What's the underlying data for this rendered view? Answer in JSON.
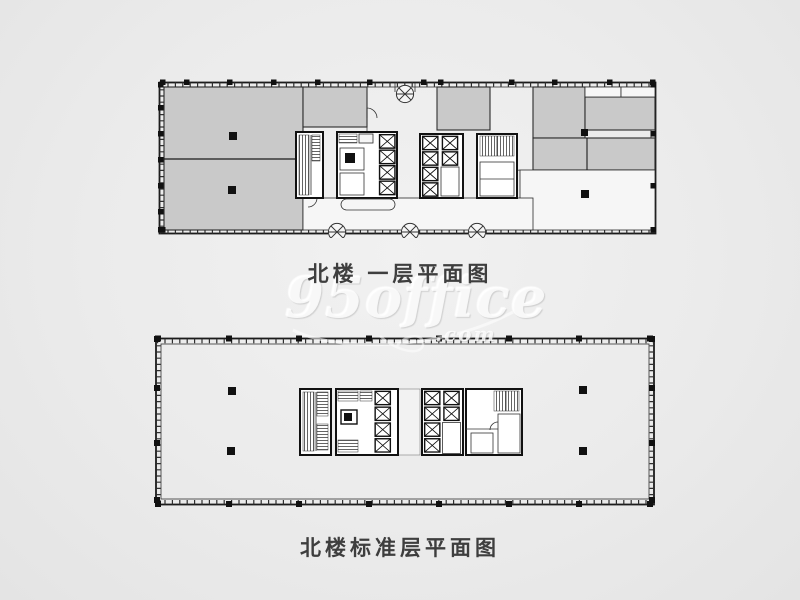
{
  "sheet": {
    "type": "floor-plan-sheet",
    "background": "#ebebeb"
  },
  "plans": [
    {
      "id": "first-floor",
      "caption": "北楼 一层平面图"
    },
    {
      "id": "standard-floor",
      "caption": "北楼标准层平面图"
    }
  ],
  "watermark": {
    "brand": "95office",
    "suffix": ".com"
  },
  "colors": {
    "floor_fill": "#c9c9c9",
    "wall": "#1b1b1b",
    "caption_text": "#3e3e3e",
    "watermark": "#ffffff",
    "background": "#ebebeb"
  }
}
